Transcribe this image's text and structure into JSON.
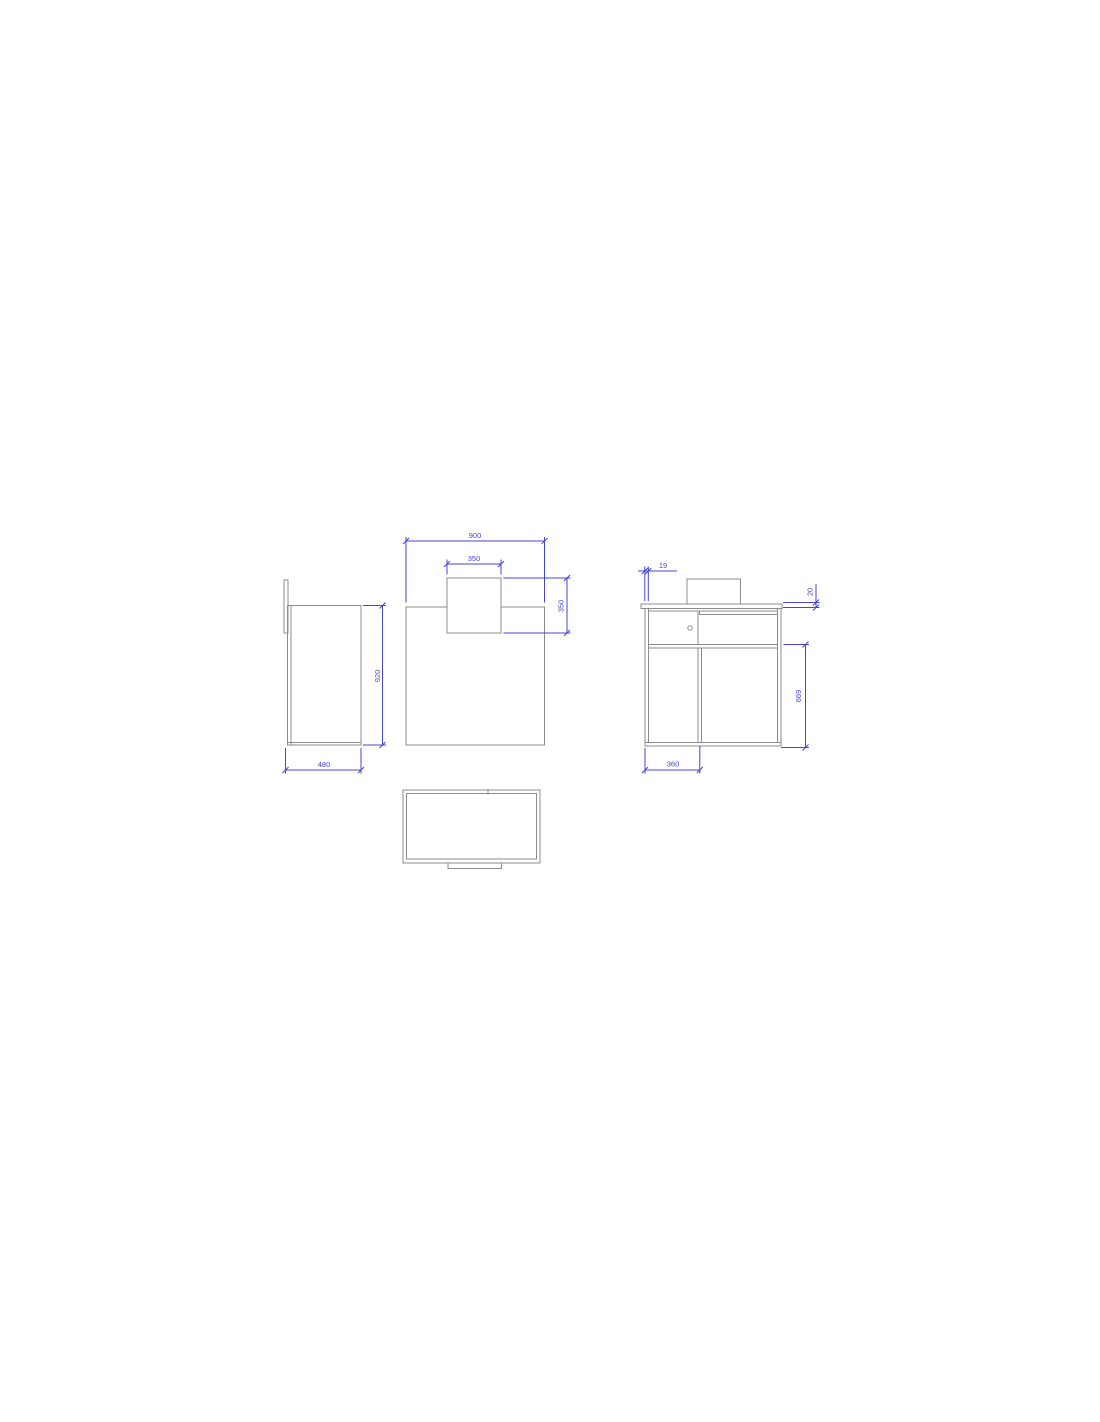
{
  "drawing": {
    "colors": {
      "background": "#ffffff",
      "geometry_line": "#8c8c8c",
      "dimension": "#4545cf"
    },
    "views": {
      "side": {
        "dims": {
          "height": "920",
          "depth": "480"
        }
      },
      "front": {
        "dims": {
          "width": "900",
          "hatch_width": "350",
          "hatch_height": "350"
        }
      },
      "section": {
        "dims": {
          "panel_thickness": "19",
          "top_thickness": "20",
          "lower_height": "669",
          "compartment_width": "360"
        }
      }
    }
  }
}
